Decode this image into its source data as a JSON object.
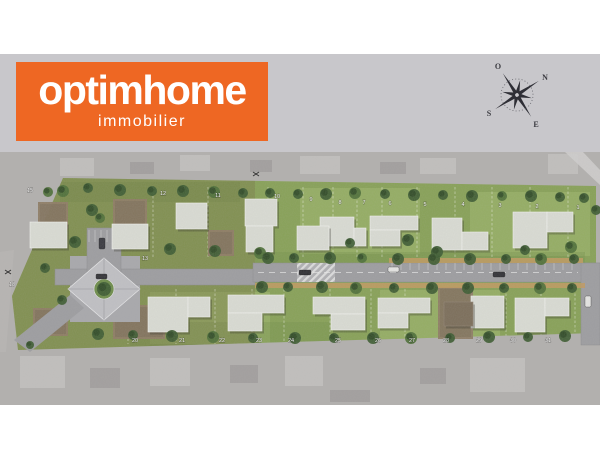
{
  "brand": {
    "name": "optimhome",
    "tagline": "immobilier",
    "bg_color": "#ee6723",
    "text_color": "#ffffff"
  },
  "compass": {
    "labels": {
      "north": "N",
      "south": "S",
      "east": "E",
      "west": "O"
    },
    "rotation_deg": 57,
    "color": "#2e2e35"
  },
  "site_plan": {
    "colors": {
      "aerial_base": "#b2b0ae",
      "aerial_light": "#c6c4c2",
      "aerial_dark": "#9b9997",
      "lawn": "#87a156",
      "lawn_light": "#b8cc82",
      "lawn_dark": "#6c8a44",
      "olive_tint": "rgba(110,96,60,0.28)",
      "dirt": "#8d7b63",
      "road": "#9d9da0",
      "road_edge": "#8b8b8e",
      "sidewalk": "#c29a5f",
      "house": "#dadcd4",
      "house_stroke": "#f4f4f0",
      "house_brown": "#7b6d59",
      "tree": "#3d5c31",
      "tree_dark": "#2d4724",
      "tree_light": "#4e7038",
      "plaza": "#c0c0c4",
      "plaza_pad": "#a8a8ac",
      "label": "#ffffff"
    },
    "parcel_polygon": [
      [
        63,
        26
      ],
      [
        596,
        34
      ],
      [
        596,
        181
      ],
      [
        18,
        198
      ],
      [
        12,
        144
      ]
    ],
    "olive_zone": [
      12,
      26,
      243,
      172
    ],
    "lawn_patches_light": [
      [
        300,
        36,
        120,
        66
      ],
      [
        470,
        40,
        120,
        64
      ],
      [
        150,
        140,
        120,
        52
      ],
      [
        380,
        138,
        120,
        50
      ]
    ],
    "lawn_patches_dark": [
      [
        255,
        100,
        330,
        12
      ],
      [
        60,
        30,
        180,
        20
      ],
      [
        130,
        170,
        200,
        24
      ]
    ],
    "lot_lines": {
      "top": {
        "y1": 35,
        "y2": 105,
        "xs": [
          153,
          208,
          268,
          303,
          333,
          357,
          382,
          417,
          455,
          492,
          530,
          568
        ]
      },
      "bottom": {
        "y1": 137,
        "y2": 192,
        "xs": [
          128,
          176,
          215,
          252,
          284,
          330,
          371,
          405,
          439,
          472,
          506,
          541,
          575
        ]
      }
    },
    "roads": {
      "main": [
        253,
        111,
        347,
        19
      ],
      "right_vert": [
        581,
        111,
        19,
        82
      ],
      "left": [
        55,
        117,
        200,
        16
      ],
      "stub": [
        87,
        76,
        34,
        44
      ],
      "plaza_pad": [
        70,
        104,
        70,
        66
      ],
      "crosswalk": [
        297,
        111,
        38,
        19
      ],
      "entrance_path": "M70,143 L84,156 L30,200 L14,188 Z",
      "centerline": {
        "x1": 258,
        "y": 120.5,
        "x2": 578
      },
      "sidewalks": [
        [
          255,
          131,
          330,
          5
        ],
        [
          389,
          106,
          194,
          5
        ]
      ],
      "parking_ticks_main": {
        "x1": 392,
        "x2": 578,
        "step": 9,
        "y1": 111,
        "y2": 118
      },
      "parking_ticks_stub": {
        "x1": 89,
        "x2": 119,
        "step": 6,
        "y1": 78,
        "y2": 90
      }
    },
    "plaza": {
      "diamond": [
        [
          104,
          106
        ],
        [
          140,
          137
        ],
        [
          104,
          168
        ],
        [
          68,
          137
        ]
      ],
      "center": [
        104,
        137
      ],
      "green_r": 10
    },
    "dirt_lots": [
      [
        38,
        50,
        30,
        27
      ],
      [
        113,
        47,
        34,
        29
      ],
      [
        208,
        78,
        26,
        26
      ],
      [
        33,
        156,
        35,
        28
      ],
      [
        113,
        153,
        52,
        34
      ],
      [
        438,
        135,
        35,
        52
      ]
    ],
    "houses": [
      {
        "type": "gray",
        "rects": [
          [
            320,
            65,
            34,
            29
          ],
          [
            354,
            76,
            12,
            18
          ]
        ]
      },
      {
        "type": "gray",
        "rects": [
          [
            370,
            64,
            48,
            14
          ],
          [
            370,
            78,
            30,
            16
          ]
        ]
      },
      {
        "type": "gray",
        "rects": [
          [
            432,
            66,
            30,
            32
          ],
          [
            462,
            80,
            26,
            18
          ]
        ]
      },
      {
        "type": "gray",
        "rects": [
          [
            513,
            60,
            34,
            36
          ],
          [
            547,
            60,
            26,
            20
          ]
        ]
      },
      {
        "type": "gray",
        "rects": [
          [
            176,
            51,
            31,
            26
          ]
        ]
      },
      {
        "type": "gray",
        "rects": [
          [
            245,
            47,
            32,
            27
          ]
        ]
      },
      {
        "type": "gray",
        "rects": [
          [
            246,
            74,
            27,
            26
          ]
        ]
      },
      {
        "type": "gray",
        "rects": [
          [
            297,
            74,
            32,
            24
          ]
        ]
      },
      {
        "type": "gray",
        "rects": [
          [
            30,
            70,
            37,
            26
          ]
        ]
      },
      {
        "type": "gray",
        "rects": [
          [
            112,
            72,
            36,
            25
          ]
        ]
      },
      {
        "type": "gray",
        "rects": [
          [
            148,
            145,
            40,
            35
          ],
          [
            188,
            145,
            22,
            20
          ]
        ]
      },
      {
        "type": "gray",
        "rects": [
          [
            228,
            143,
            56,
            18
          ],
          [
            228,
            161,
            34,
            18
          ]
        ]
      },
      {
        "type": "gray",
        "rects": [
          [
            313,
            145,
            52,
            17
          ],
          [
            331,
            162,
            34,
            16
          ]
        ]
      },
      {
        "type": "gray",
        "rects": [
          [
            378,
            146,
            52,
            15
          ],
          [
            378,
            161,
            30,
            15
          ]
        ]
      },
      {
        "type": "gray",
        "rects": [
          [
            471,
            144,
            33,
            32
          ]
        ]
      },
      {
        "type": "gray",
        "rects": [
          [
            515,
            146,
            30,
            34
          ],
          [
            545,
            146,
            24,
            18
          ]
        ]
      },
      {
        "type": "brown",
        "rects": [
          [
            444,
            150,
            29,
            24
          ]
        ]
      }
    ],
    "lot_labels": [
      {
        "text": "1",
        "x": 578,
        "y": 57
      },
      {
        "text": "2",
        "x": 537,
        "y": 56
      },
      {
        "text": "3",
        "x": 500,
        "y": 55
      },
      {
        "text": "4",
        "x": 463,
        "y": 54
      },
      {
        "text": "5",
        "x": 425,
        "y": 54
      },
      {
        "text": "6",
        "x": 390,
        "y": 53
      },
      {
        "text": "7",
        "x": 364,
        "y": 52
      },
      {
        "text": "8",
        "x": 340,
        "y": 52
      },
      {
        "text": "9",
        "x": 311,
        "y": 49
      },
      {
        "text": "10",
        "x": 277,
        "y": 46
      },
      {
        "text": "11",
        "x": 218,
        "y": 45
      },
      {
        "text": "12",
        "x": 163,
        "y": 43
      },
      {
        "text": "15",
        "x": 30,
        "y": 40
      },
      {
        "text": "13",
        "x": 145,
        "y": 108
      },
      {
        "text": "18",
        "x": 12,
        "y": 134
      },
      {
        "text": "20",
        "x": 135,
        "y": 190
      },
      {
        "text": "21",
        "x": 182,
        "y": 190
      },
      {
        "text": "22",
        "x": 222,
        "y": 190
      },
      {
        "text": "23",
        "x": 259,
        "y": 190
      },
      {
        "text": "24",
        "x": 291,
        "y": 190
      },
      {
        "text": "25",
        "x": 338,
        "y": 190
      },
      {
        "text": "26",
        "x": 378,
        "y": 190
      },
      {
        "text": "27",
        "x": 412,
        "y": 190
      },
      {
        "text": "28",
        "x": 446,
        "y": 190
      },
      {
        "text": "29",
        "x": 479,
        "y": 190
      },
      {
        "text": "30",
        "x": 513,
        "y": 190
      },
      {
        "text": "31",
        "x": 548,
        "y": 190
      }
    ],
    "trees": [
      [
        63,
        39,
        6
      ],
      [
        88,
        36,
        5
      ],
      [
        120,
        38,
        6
      ],
      [
        152,
        39,
        5
      ],
      [
        183,
        39,
        6
      ],
      [
        214,
        40,
        6
      ],
      [
        243,
        41,
        5
      ],
      [
        270,
        41,
        5
      ],
      [
        298,
        42,
        5
      ],
      [
        326,
        42,
        6
      ],
      [
        355,
        41,
        6
      ],
      [
        385,
        42,
        5
      ],
      [
        414,
        43,
        6
      ],
      [
        443,
        43,
        5
      ],
      [
        472,
        44,
        6
      ],
      [
        502,
        44,
        5
      ],
      [
        531,
        44,
        6
      ],
      [
        560,
        45,
        5
      ],
      [
        584,
        46,
        5
      ],
      [
        92,
        58,
        6
      ],
      [
        100,
        66,
        5
      ],
      [
        75,
        90,
        6
      ],
      [
        45,
        116,
        5
      ],
      [
        170,
        97,
        6
      ],
      [
        215,
        99,
        6
      ],
      [
        260,
        101,
        6
      ],
      [
        350,
        91,
        5
      ],
      [
        408,
        88,
        6
      ],
      [
        437,
        100,
        6
      ],
      [
        525,
        98,
        5
      ],
      [
        571,
        95,
        6
      ],
      [
        596,
        58,
        5
      ],
      [
        268,
        106,
        6
      ],
      [
        294,
        106,
        5
      ],
      [
        330,
        106,
        6
      ],
      [
        362,
        106,
        5
      ],
      [
        398,
        107,
        6
      ],
      [
        434,
        107,
        6
      ],
      [
        470,
        107,
        6
      ],
      [
        506,
        107,
        5
      ],
      [
        541,
        107,
        6
      ],
      [
        574,
        107,
        5
      ],
      [
        262,
        135,
        6
      ],
      [
        288,
        135,
        5
      ],
      [
        322,
        135,
        6
      ],
      [
        356,
        136,
        6
      ],
      [
        394,
        136,
        5
      ],
      [
        432,
        136,
        6
      ],
      [
        468,
        136,
        6
      ],
      [
        504,
        136,
        5
      ],
      [
        540,
        136,
        6
      ],
      [
        572,
        136,
        5
      ],
      [
        98,
        182,
        6
      ],
      [
        133,
        183,
        5
      ],
      [
        172,
        184,
        6
      ],
      [
        213,
        185,
        6
      ],
      [
        253,
        186,
        5
      ],
      [
        295,
        186,
        6
      ],
      [
        334,
        186,
        5
      ],
      [
        373,
        186,
        6
      ],
      [
        411,
        186,
        6
      ],
      [
        450,
        186,
        5
      ],
      [
        489,
        185,
        6
      ],
      [
        528,
        185,
        5
      ],
      [
        565,
        184,
        6
      ],
      [
        48,
        40,
        5
      ],
      [
        62,
        148,
        5
      ],
      [
        30,
        193,
        4
      ],
      [
        104,
        137,
        7
      ]
    ],
    "cars": [
      {
        "x": 96,
        "y": 122,
        "w": 11,
        "h": 5,
        "c": "#2b2b30"
      },
      {
        "x": 99,
        "y": 86,
        "w": 6,
        "h": 11,
        "c": "#33333a"
      },
      {
        "x": 299,
        "y": 118,
        "w": 12,
        "h": 5,
        "c": "#26262b"
      },
      {
        "x": 388,
        "y": 115,
        "w": 11,
        "h": 5,
        "c": "#e9e9e7"
      },
      {
        "x": 493,
        "y": 120,
        "w": 12,
        "h": 5,
        "c": "#2b2b30"
      },
      {
        "x": 585,
        "y": 144,
        "w": 6,
        "h": 11,
        "c": "#e9e9e7"
      }
    ],
    "aerial": {
      "light_blobs": [
        [
          60,
          6,
          34,
          18
        ],
        [
          180,
          3,
          30,
          16
        ],
        [
          300,
          4,
          40,
          18
        ],
        [
          420,
          6,
          36,
          16
        ],
        [
          548,
          2,
          30,
          20
        ],
        [
          20,
          204,
          45,
          32
        ],
        [
          150,
          206,
          40,
          28
        ],
        [
          285,
          204,
          38,
          30
        ],
        [
          470,
          206,
          55,
          34
        ]
      ],
      "dark_blobs": [
        [
          130,
          10,
          24,
          12
        ],
        [
          250,
          8,
          22,
          12
        ],
        [
          380,
          10,
          26,
          12
        ],
        [
          90,
          216,
          30,
          20
        ],
        [
          230,
          213,
          28,
          18
        ],
        [
          420,
          216,
          26,
          16
        ],
        [
          330,
          238,
          40,
          12
        ]
      ],
      "topright_road": "M565,0 L583,0 L600,18 L600,33 Z",
      "left_road": "M0,100 L14,98 L6,200 L0,200 Z",
      "bird_marks": [
        [
          256,
          22
        ],
        [
          8,
          120
        ]
      ]
    }
  }
}
